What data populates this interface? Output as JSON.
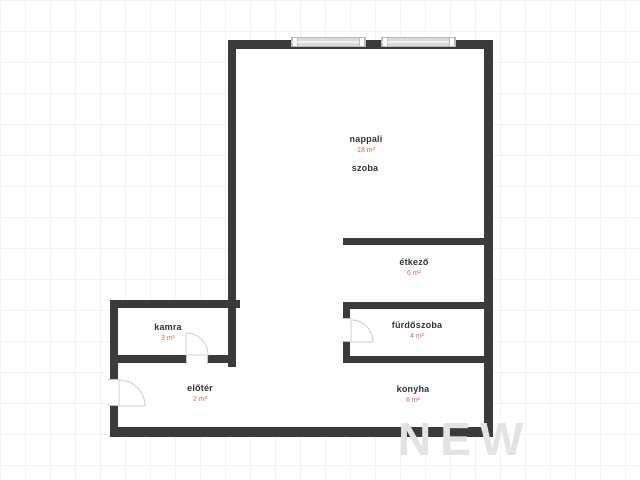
{
  "plan": {
    "title": "apartment-floorplan",
    "watermark_text": "NEW",
    "colors": {
      "wall": "#3b3b3b",
      "room_name_text": "#333333",
      "room_area_text": "#dd6950",
      "window_fill": "#dadada",
      "door_arc": "#cfcfcf",
      "grid_line": "#f7f1f1",
      "watermark": "#e3e3e3",
      "floor_fill": "#ffffff"
    },
    "rooms": [
      {
        "name": "nappali",
        "area": "18 m²"
      },
      {
        "name": "szoba",
        "area": ""
      },
      {
        "name": "étkező",
        "area": "6 m²"
      },
      {
        "name": "fürdőszoba",
        "area": "4 m²"
      },
      {
        "name": "konyha",
        "area": "6 m²"
      },
      {
        "name": "kamra",
        "area": "3 m²"
      },
      {
        "name": "előtér",
        "area": "2 m²"
      }
    ]
  }
}
